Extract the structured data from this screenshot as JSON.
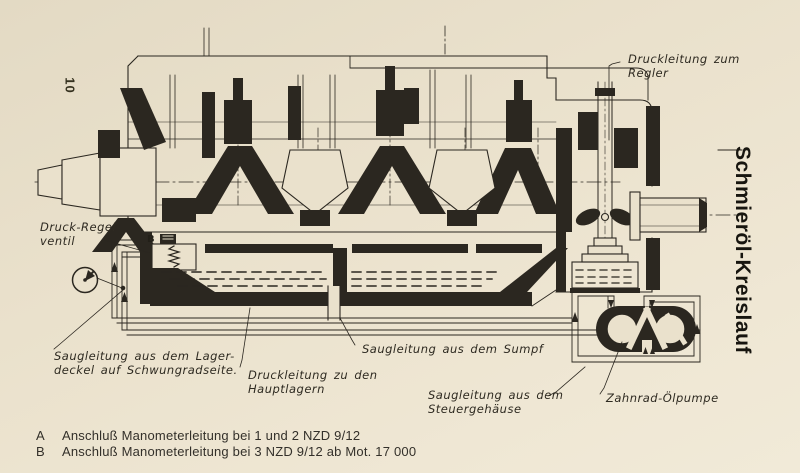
{
  "page": {
    "number": "10",
    "side_title": "Schmieröl-Kreislauf"
  },
  "labels": {
    "regler": {
      "line1": "Druckleitung zum",
      "line2": "Regler"
    },
    "regelventil": {
      "line1": "Druck-Regel-",
      "line2": "ventil"
    },
    "lagerdeckel": {
      "line1": "Saugleitung aus dem Lager-",
      "line2": "deckel auf Schwungradseite."
    },
    "hauptlager": {
      "line1": "Druckleitung zu den",
      "line2": "Hauptlagern"
    },
    "sumpf": {
      "line1": "Saugleitung aus dem Sumpf"
    },
    "steuergehaeuse": {
      "line1": "Saugleitung aus dem",
      "line2": "Steuergehäuse"
    },
    "pumpe": {
      "line1": "Zahnrad-Ölpumpe"
    }
  },
  "markers": {
    "valve": "B"
  },
  "legend": {
    "rows": [
      {
        "key": "A",
        "text": "Anschluß Manometerleitung bei 1 und 2 NZD 9/12"
      },
      {
        "key": "B",
        "text": "Anschluß Manometerleitung bei 3 NZD 9/12 ab Mot. 17 000"
      }
    ]
  },
  "colors": {
    "paper": "#eae1cc",
    "ink": "#2b2720"
  }
}
